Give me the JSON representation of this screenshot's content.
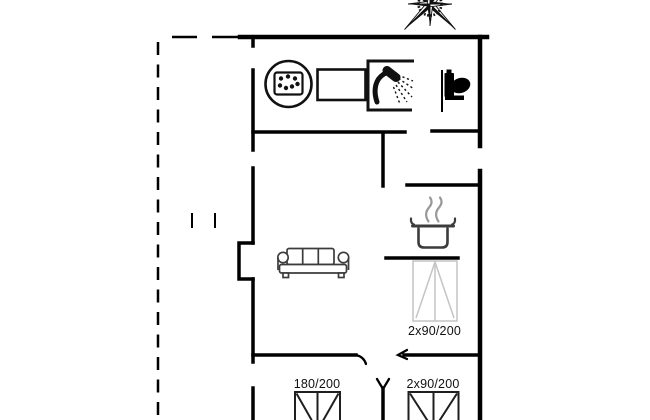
{
  "labels": {
    "bed_middle": "2x90/200",
    "bed_bottom_left": "180/200",
    "bed_bottom_right": "2x90/200"
  },
  "colors": {
    "background": "#ffffff",
    "walls": "#000000",
    "furniture_dark": "#3c3c3c",
    "steam": "#999999",
    "bed_light": "#c4c4c4",
    "bed_dark": "#1f1f1f",
    "label_text": "#111111"
  },
  "icons": [
    {
      "name": "compass-rose-icon"
    },
    {
      "name": "spa-bath-icon"
    },
    {
      "name": "washbasin-icon"
    },
    {
      "name": "shower-icon"
    },
    {
      "name": "toilet-icon"
    },
    {
      "name": "cooking-pot-icon"
    },
    {
      "name": "steam-icon"
    },
    {
      "name": "sofa-icon"
    },
    {
      "name": "double-bed-icon"
    },
    {
      "name": "chimney-niche"
    },
    {
      "name": "terrace-dashed-outline"
    }
  ]
}
